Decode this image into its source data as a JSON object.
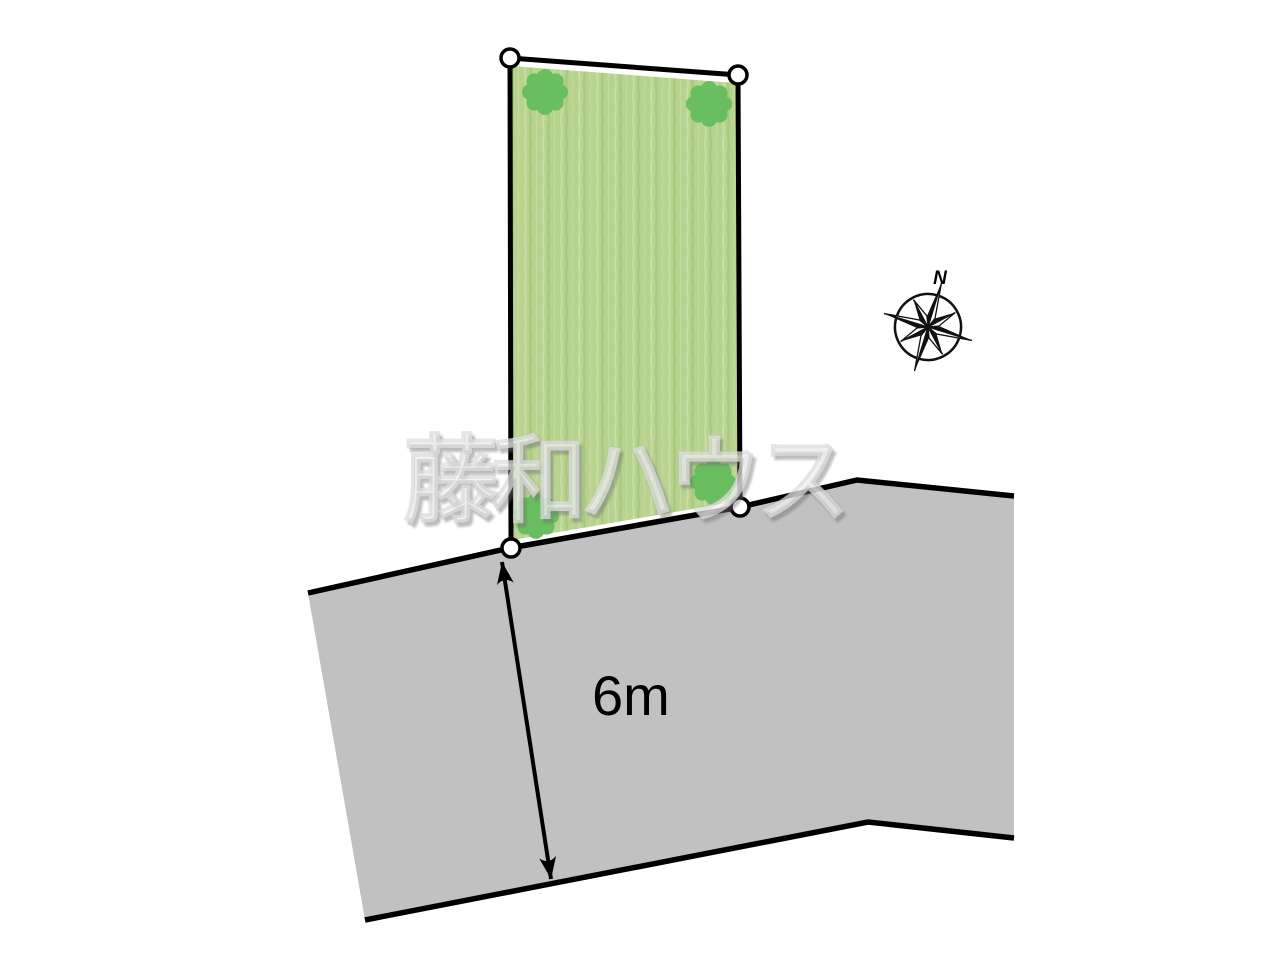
{
  "scene": {
    "background": "#ffffff",
    "description": "Real-estate land plot site diagram with green parcel, gray road and compass"
  },
  "watermark": {
    "text": "藤和ハウス"
  },
  "compass": {
    "label": "N"
  },
  "parcel": {
    "fill": "#b7d38e",
    "outline_color": "#000000",
    "outline_points": "510,58 738,75 740,507 511,548",
    "fill_points": "511.5,66 736.5,83 738.5,501 512.5,540",
    "tree_color": "#69be5f",
    "trees": [
      {
        "transform": "translate(545,92)"
      },
      {
        "transform": "translate(709,104)"
      },
      {
        "transform": "translate(536,516)"
      },
      {
        "transform": "translate(713,482)"
      }
    ],
    "corner_markers": [
      {
        "cx": 510,
        "cy": 58
      },
      {
        "cx": 738,
        "cy": 75
      },
      {
        "cx": 740,
        "cy": 507
      },
      {
        "cx": 511,
        "cy": 548
      }
    ]
  },
  "road": {
    "fill": "#c1c1c1",
    "edge_color": "#000000",
    "area_points": "308,593 510,548 740,507 857,480 1014,496 1014,838 868,822 365,920",
    "near_edge_points": "308,593 510,548 740,507 857,480 1014,496",
    "far_edge_points": "1014,838 868,822 365,920"
  },
  "dimension": {
    "label": "6m",
    "x1": 502,
    "y1": 562,
    "x2": 551,
    "y2": 879
  }
}
